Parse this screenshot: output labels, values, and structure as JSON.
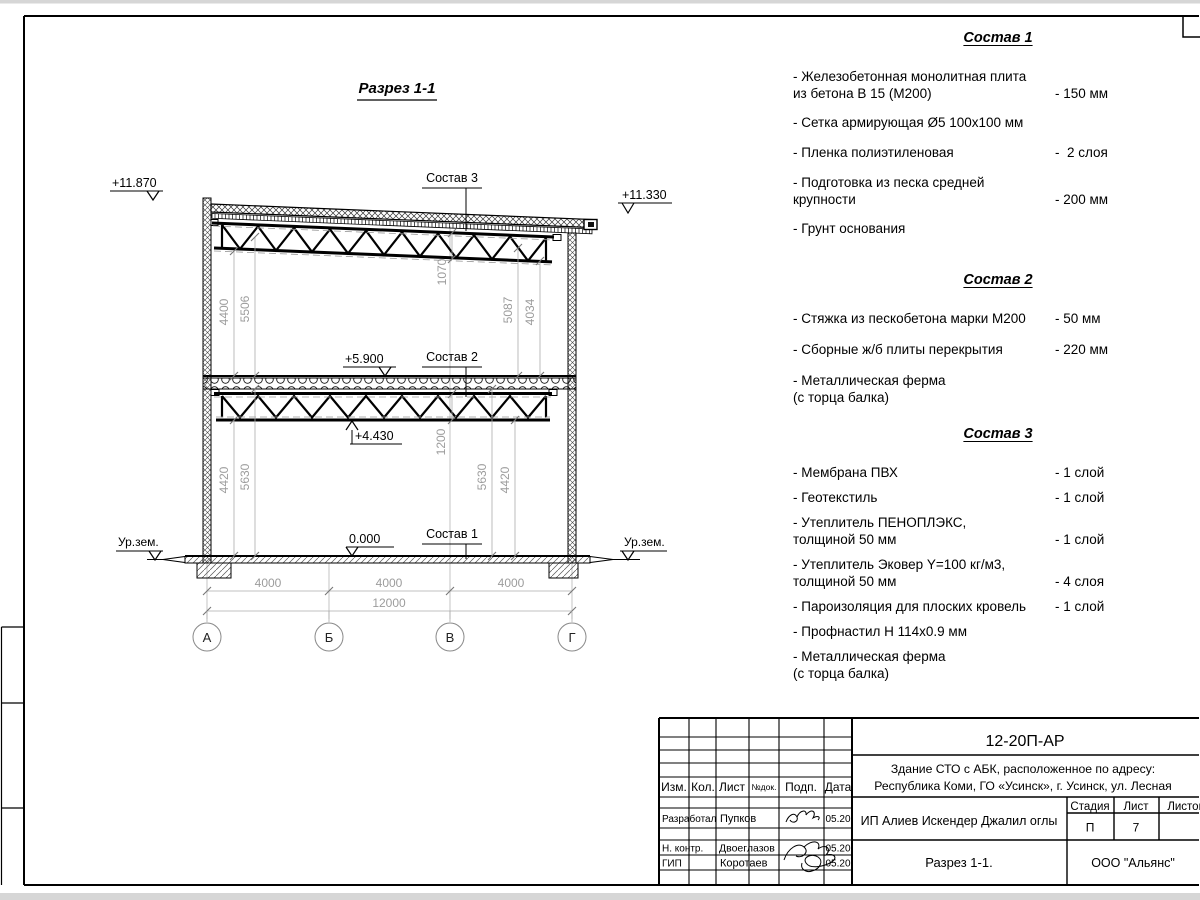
{
  "drawing": {
    "title": "Разрез 1-1",
    "levels": {
      "left_top": "+11.870",
      "right_top": "+11.330",
      "floor2": "+5.900",
      "truss2": "+4.430",
      "zero": "0.000"
    },
    "ground_left": "Ур.зем.",
    "ground_right": "Ур.зем.",
    "callouts": {
      "c1": "Состав 1",
      "c2": "Состав 2",
      "c3": "Состав 3"
    },
    "dims": {
      "bays": [
        "4000",
        "4000",
        "4000"
      ],
      "total": "12000",
      "up_left_inner": "4400",
      "up_left_outer": "5506",
      "up_mid": "1070",
      "up_right_inner": "5087",
      "up_right_outer": "4034",
      "low_left_inner": "4420",
      "low_left_outer": "5630",
      "low_mid": "1200",
      "low_right_inner": "5630",
      "low_right_outer": "4420"
    },
    "grid_axes": [
      "А",
      "Б",
      "В",
      "Г"
    ]
  },
  "compositions": [
    {
      "title": "Состав 1",
      "items": [
        {
          "name": "- Железобетонная  монолитная плита\nиз бетона В 15 (М200)",
          "value": "- 150 мм"
        },
        {
          "name": "- Сетка армирующая Ø5 100х100 мм",
          "value": ""
        },
        {
          "name": "- Пленка полиэтиленовая",
          "value": "-  2 слоя"
        },
        {
          "name": "- Подготовка из песка средней\nкрупности",
          "value": "- 200 мм"
        },
        {
          "name": "- Грунт основания",
          "value": ""
        }
      ]
    },
    {
      "title": "Состав 2",
      "items": [
        {
          "name": "- Стяжка из пескобетона марки М200",
          "value": "- 50 мм"
        },
        {
          "name": "- Сборные ж/б плиты перекрытия",
          "value": "- 220 мм"
        },
        {
          "name": "- Металлическая ферма\n(с торца балка)",
          "value": ""
        }
      ]
    },
    {
      "title": "Состав 3",
      "items": [
        {
          "name": "- Мембрана ПВХ",
          "value": "- 1 слой"
        },
        {
          "name": "- Геотекстиль",
          "value": "- 1 слой"
        },
        {
          "name": "- Утеплитель ПЕНОПЛЭКС,\nтолщиной 50 мм",
          "value": "- 1 слой"
        },
        {
          "name": "- Утеплитель Эковер Y=100 кг/м3,\nтолщиной 50 мм",
          "value": "- 4 слоя"
        },
        {
          "name": "- Пароизоляция для плоских кровель",
          "value": "- 1 слой"
        },
        {
          "name": "- Профнастил Н 114х0.9 мм",
          "value": ""
        },
        {
          "name": "- Металлическая ферма\n(с торца балка)",
          "value": ""
        }
      ]
    }
  ],
  "titleblock": {
    "doc_code": "12-20П-АР",
    "address_line1": "Здание СТО с АБК, расположенное по адресу:",
    "address_line2": "Республика Коми, ГО «Усинск», г. Усинск, ул. Лесная",
    "client": "ИП Алиев Искендер Джалил оглы",
    "sheet_title": "Разрез 1-1.",
    "company": "ООО \"Альянс\"",
    "stage_label": "Стадия",
    "sheet_label": "Лист",
    "sheets_label": "Листов",
    "stage_value": "П",
    "sheet_value": "7",
    "cols": {
      "izm": "Изм.",
      "kol": "Кол.",
      "list": "Лист",
      "ndoc": "№док.",
      "podp": "Подп.",
      "data": "Дата"
    },
    "rows": [
      {
        "role": "Разработал",
        "name": "Пупков",
        "date": "05.20"
      },
      {
        "role": "Н. контр.",
        "name": "Двоеглазов",
        "date": "05.20"
      },
      {
        "role": "ГИП",
        "name": "Коротаев",
        "date": "05.20"
      }
    ]
  }
}
